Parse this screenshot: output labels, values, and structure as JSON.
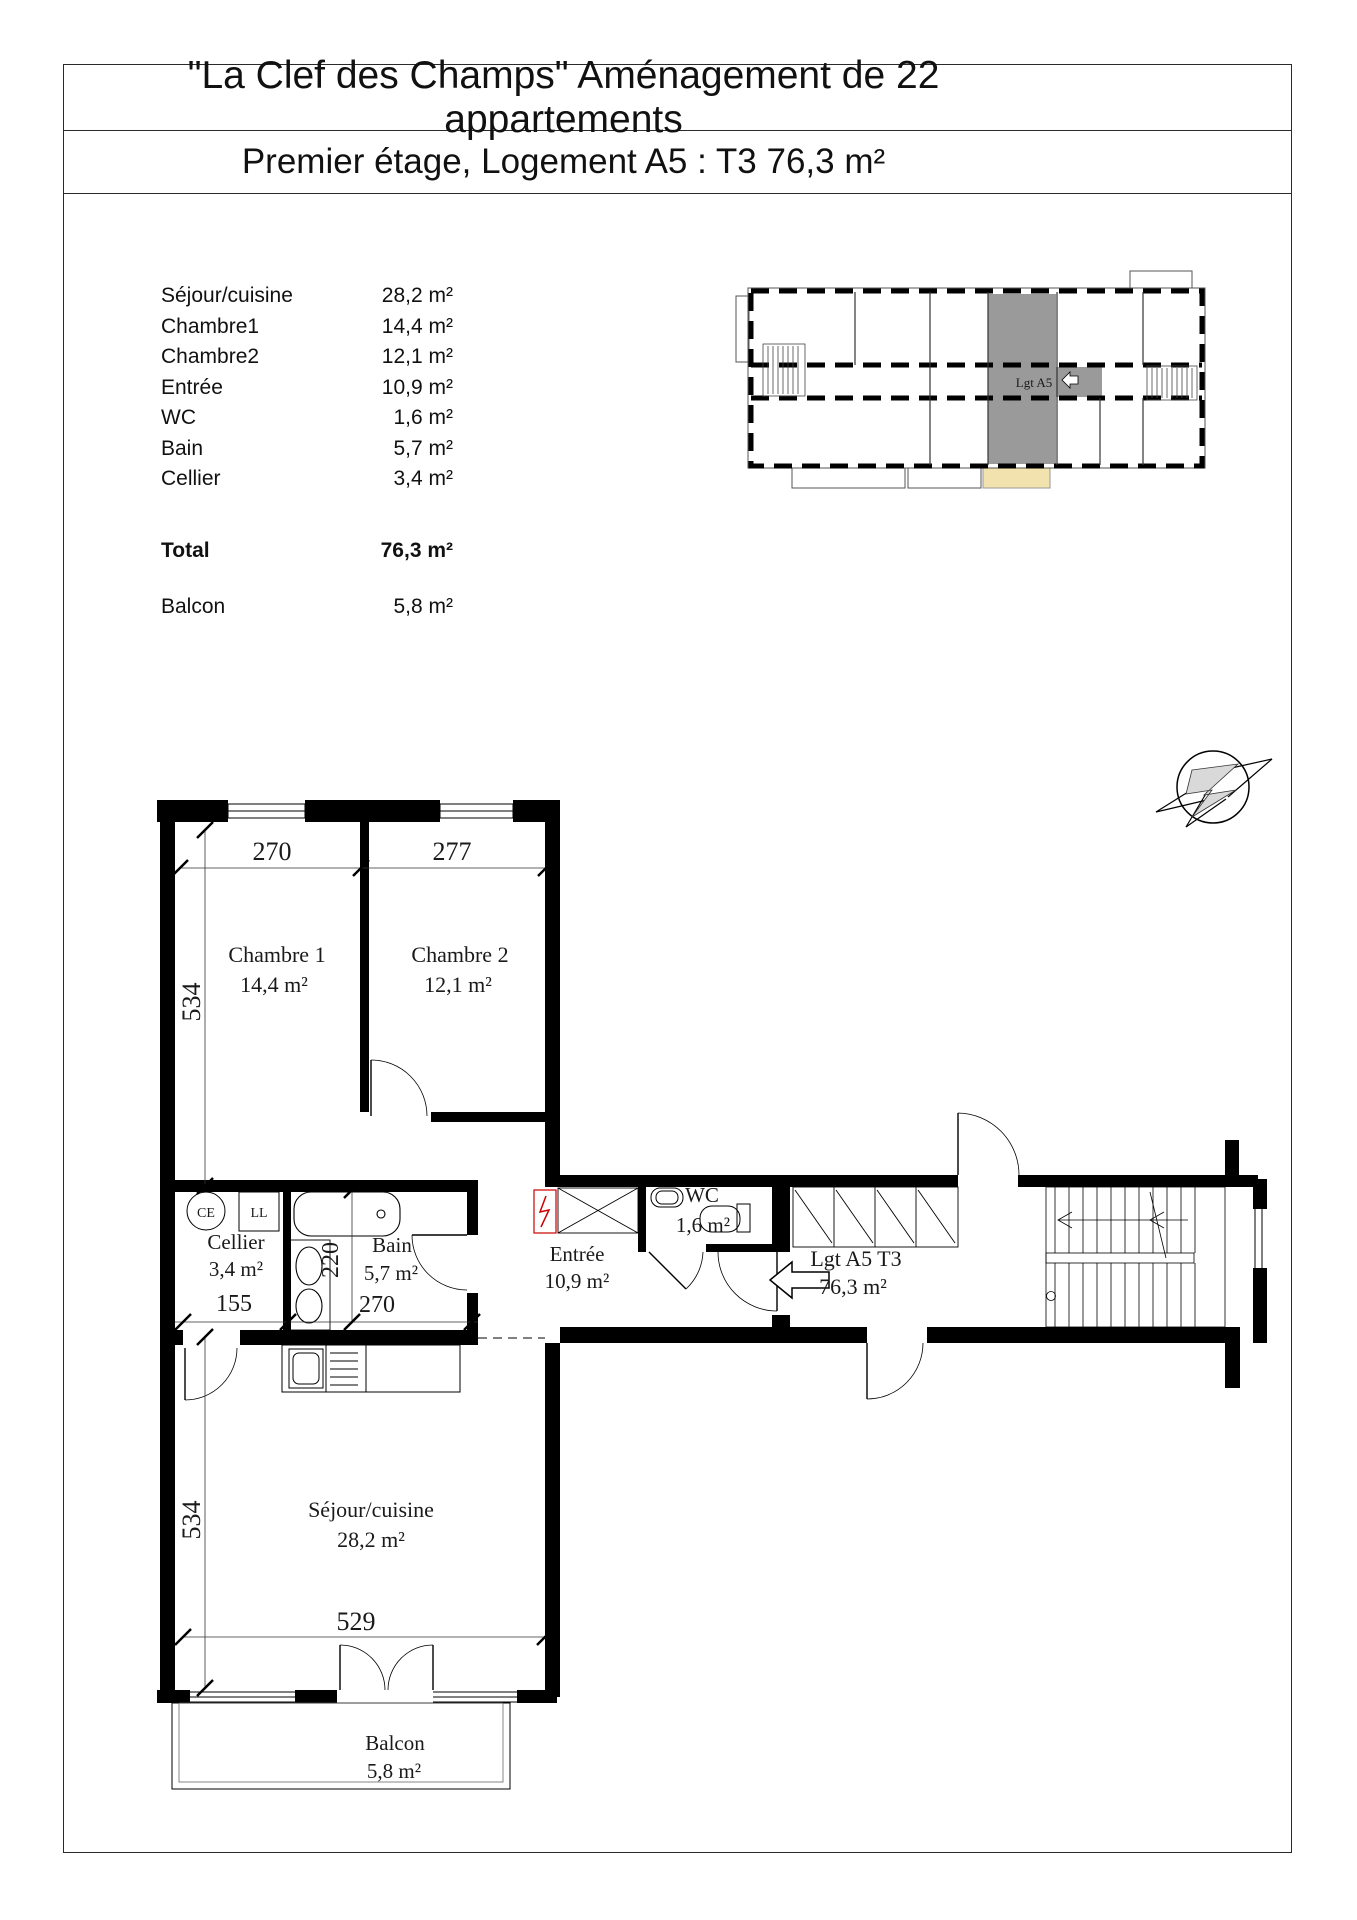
{
  "title": {
    "line1": "\"La Clef des Champs\" Aménagement de 22 appartements",
    "line2": "Premier étage, Logement A5 : T3  76,3 m²"
  },
  "area_table": {
    "rows": [
      {
        "label": "Séjour/cuisine",
        "value": "28,2 m²"
      },
      {
        "label": "Chambre1",
        "value": "14,4 m²"
      },
      {
        "label": "Chambre2",
        "value": "12,1 m²"
      },
      {
        "label": "Entrée",
        "value": "10,9 m²"
      },
      {
        "label": "WC",
        "value": "1,6 m²"
      },
      {
        "label": "Bain",
        "value": "5,7 m²"
      },
      {
        "label": "Cellier",
        "value": "3,4 m²"
      }
    ],
    "total": {
      "label": "Total",
      "value": "76,3 m²"
    },
    "balcony": {
      "label": "Balcon",
      "value": "5,8 m²"
    }
  },
  "key_plan": {
    "apartment_label": "Lgt A5",
    "highlight_color": "#9a9a9a",
    "balcony_color": "#f2e3ae"
  },
  "floor_plan": {
    "rooms": {
      "chambre1": {
        "name": "Chambre 1",
        "area": "14,4 m²"
      },
      "chambre2": {
        "name": "Chambre 2",
        "area": "12,1 m²"
      },
      "cellier": {
        "name": "Cellier",
        "area": "3,4 m²"
      },
      "bain": {
        "name": "Bain",
        "area": "5,7 m²"
      },
      "entree": {
        "name": "Entrée",
        "area": "10,9 m²"
      },
      "wc": {
        "name": "WC",
        "area": "1,6 m²"
      },
      "sejour": {
        "name": "Séjour/cuisine",
        "area": "28,2 m²"
      },
      "balcon": {
        "name": "Balcon",
        "area": "5,8 m²"
      }
    },
    "apartment": {
      "line1": "Lgt A5 T3",
      "line2": "76,3 m²"
    },
    "dims": {
      "chambre1_width": "270",
      "chambre2_width": "277",
      "bedrooms_depth": "534",
      "cellier_width": "155",
      "bain_depth": "220",
      "bain_width": "270",
      "sejour_width": "529",
      "sejour_depth": "534"
    },
    "equipment": {
      "water_heater": "CE",
      "washing_machine": "LL"
    }
  }
}
